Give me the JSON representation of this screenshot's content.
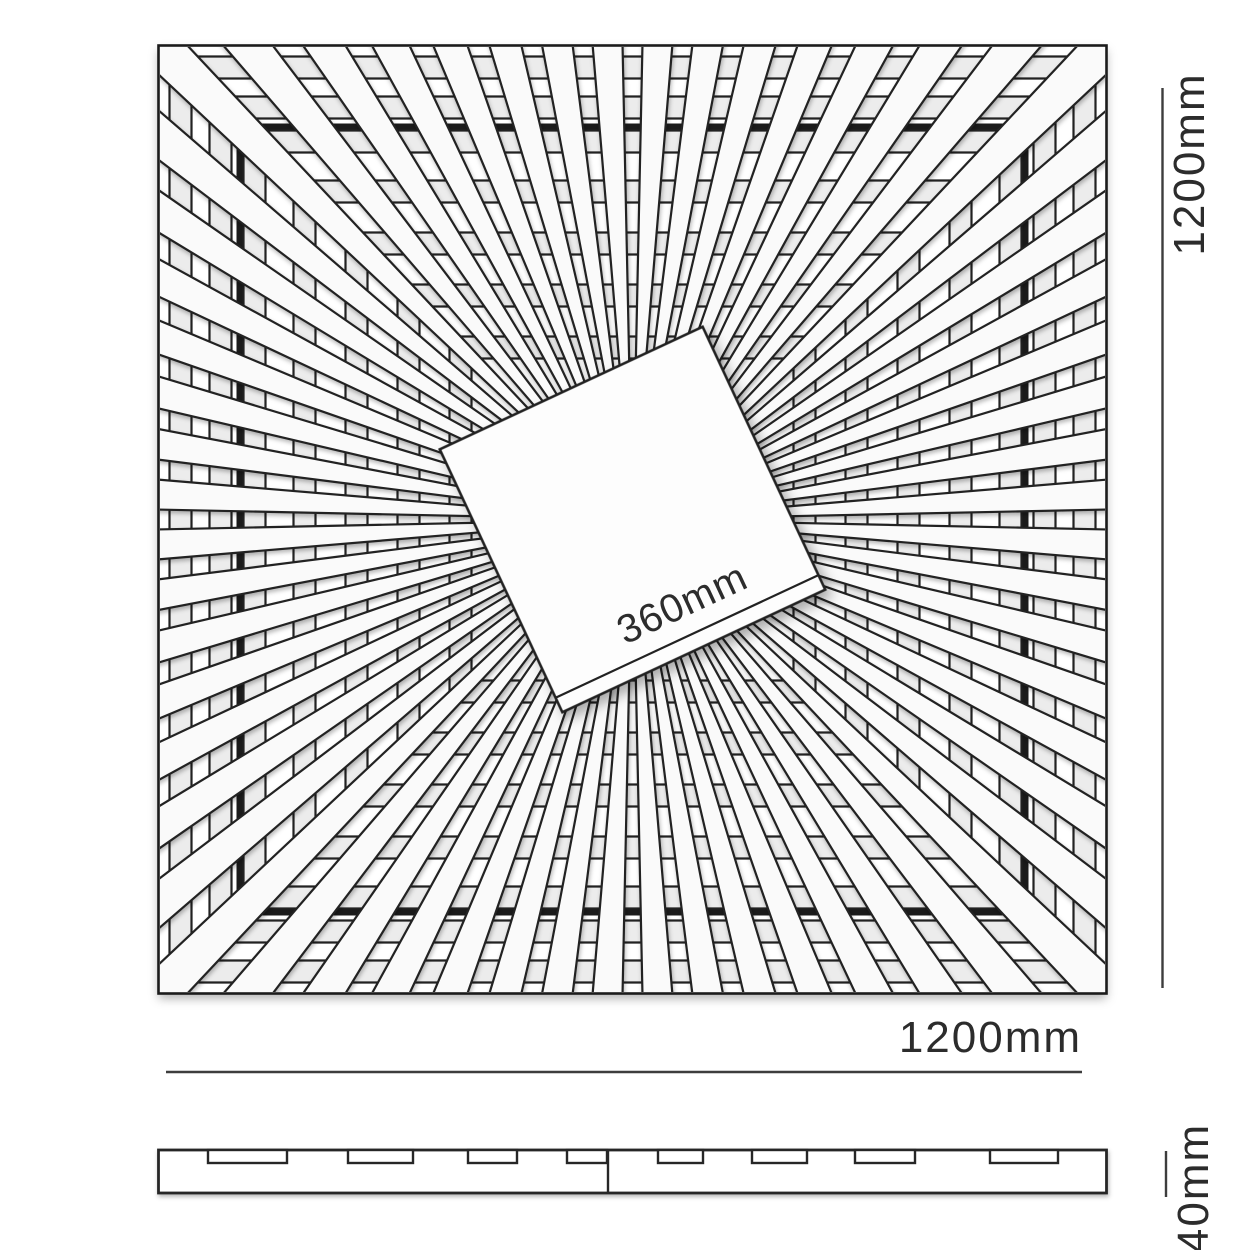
{
  "drawing": {
    "kind": "technical-dimension-drawing",
    "views": [
      "plan-sunburst-panel",
      "side-profile"
    ]
  },
  "plan": {
    "frame": {
      "x": 158.5,
      "y": 45.5,
      "size": 948,
      "stroke_w": 2.6
    },
    "inner_frame": {
      "inset": 81,
      "stroke_w": 6
    },
    "spokes": {
      "count": 60,
      "offset_deg": 3,
      "width_deg": 3.6,
      "inner_radius": 100,
      "outer_radius": 700
    },
    "rings": {
      "half_sides": [
        172,
        224,
        276,
        328,
        378,
        412,
        452
      ],
      "strip_w": 22
    },
    "center_square": {
      "side": 290,
      "rotation_deg": -25,
      "facet_inset": 16,
      "label": "360mm",
      "label_x": 642,
      "label_y": 630,
      "label_font": 40
    }
  },
  "profile": {
    "x": 158.5,
    "y": 1150,
    "w": 948,
    "h": 43,
    "seam_x": 608,
    "notch_h": 13,
    "notches": [
      [
        208,
        79
      ],
      [
        348,
        65
      ],
      [
        468,
        49
      ],
      [
        567,
        40
      ],
      [
        658,
        45
      ],
      [
        752,
        55
      ],
      [
        855,
        60
      ],
      [
        990,
        68
      ]
    ]
  },
  "dimensions": {
    "height": {
      "label": "1200mm",
      "x": 1162.5,
      "y1": 88,
      "y2": 988
    },
    "width": {
      "label": "1200mm",
      "x1": 166,
      "x2": 1082,
      "y": 1072
    },
    "thickness": {
      "label": "40mm",
      "x": 1166,
      "y1": 1151,
      "y2": 1197
    }
  },
  "colors": {
    "background": "#ffffff",
    "line": "#222222",
    "frame": "#1b1b1b",
    "dim_line": "#3d3d3d",
    "text": "#2c2c2c",
    "spoke_fill": "#fafafa",
    "ring_fill": "#ececec",
    "panel_fill": "#ffffff"
  }
}
